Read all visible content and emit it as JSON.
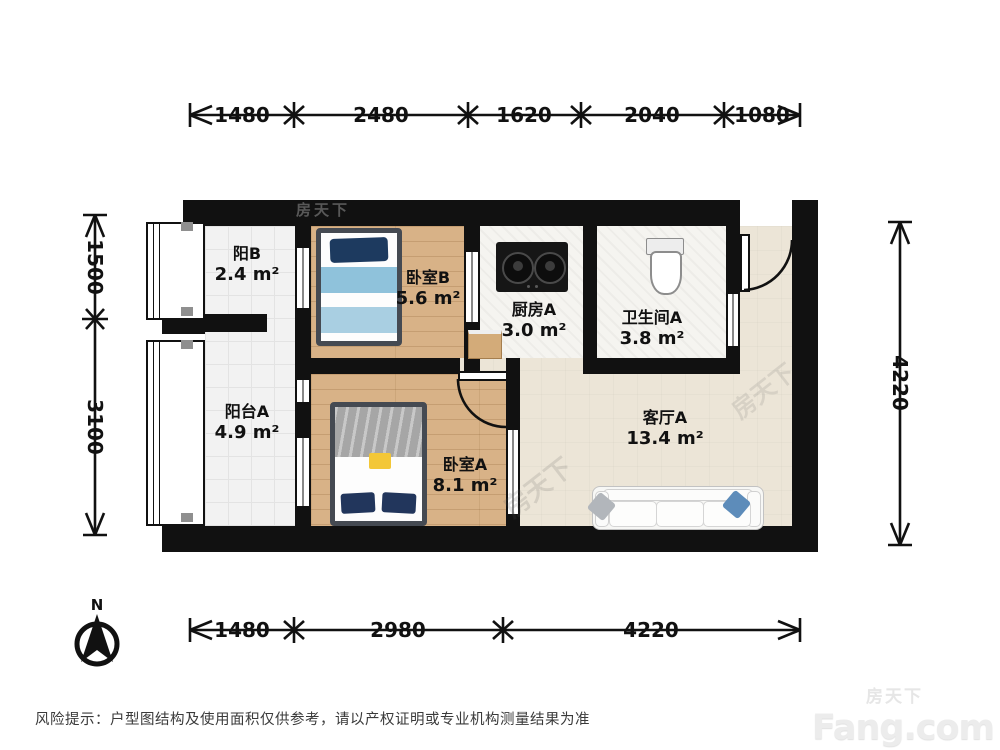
{
  "dimensions": {
    "top": [
      "1480",
      "2480",
      "1620",
      "2040",
      "1080"
    ],
    "left": [
      "1500",
      "3100"
    ],
    "right": [
      "4220"
    ],
    "bottom": [
      "1480",
      "2980",
      "4220"
    ]
  },
  "rooms": {
    "balcony_b": {
      "name": "阳B",
      "area": "2.4 m²"
    },
    "bedroom_b": {
      "name": "卧室B",
      "area": "5.6 m²"
    },
    "kitchen_a": {
      "name": "厨房A",
      "area": "3.0 m²"
    },
    "bathroom_a": {
      "name": "卫生间A",
      "area": "3.8 m²"
    },
    "balcony_a": {
      "name": "阳台A",
      "area": "4.9 m²"
    },
    "bedroom_a": {
      "name": "卧室A",
      "area": "8.1 m²"
    },
    "living_a": {
      "name": "客厅A",
      "area": "13.4 m²"
    }
  },
  "compass": {
    "north_label": "N"
  },
  "footer": {
    "disclaimer": "风险提示：户型图结构及使用面积仅供参考，请以产权证明或专业机构测量结果为准"
  },
  "brand": {
    "cn": "房天下",
    "en": "Fang.com"
  },
  "watermark": {
    "text": "房天下"
  },
  "colors": {
    "wall": "#111111",
    "wood": "#d8b287",
    "tile": "#f2f2f2",
    "living_floor": "#ece5d7",
    "pillow_navy": "#22365c",
    "blanket_blue": "#8fc2db",
    "sofa_pillow_blue": "#5d8cba"
  }
}
